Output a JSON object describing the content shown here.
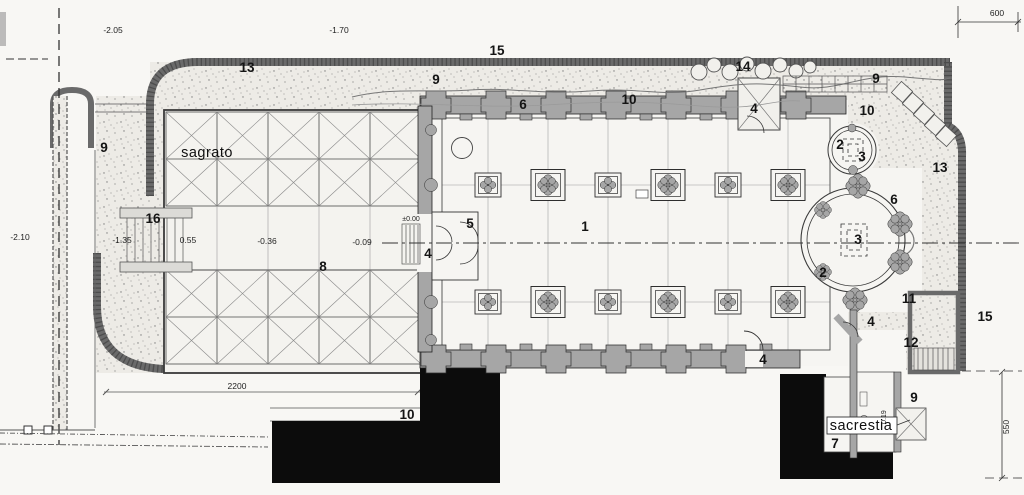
{
  "drawing": {
    "kind": "scanned architectural site plan of a church",
    "rooms": {
      "sagrato": "sagrato",
      "sacrestia": "sacrestia"
    }
  },
  "colors": {
    "paper": "#f8f7f4",
    "grass_base": "#edebe6",
    "wall_fill": "#a6a6a6",
    "wall_band": "#6a6a6a",
    "ink": "#2e2e2e",
    "black_mass": "#0c0c0c"
  },
  "labels": {
    "dim_205": "-2.05",
    "dim_170": "-1.70",
    "dim_600": "600",
    "dim_210": "-2.10",
    "dim_2200": "2200",
    "dim_550": "550",
    "lv_135": "-1.35",
    "lv_055": "0.55",
    "lv_036": "-0.36",
    "lv_009": "-0.09",
    "lv_000": "±0.00",
    "lv_019": "0.19",
    "n1": "1",
    "n2_chapel": "2",
    "n2_apse": "2",
    "n3_chapel": "3",
    "n3_altar": "3",
    "n4_north": "4",
    "n4_west": "4",
    "n4_south": "4",
    "n4_sacrestia": "4",
    "n5": "5",
    "n6_top": "6",
    "n6_apse": "6",
    "n7": "7",
    "n8": "8",
    "n9_left": "9",
    "n9_topcenter": "9",
    "n9_topright": "9",
    "n9_corridor": "9",
    "n10_topwall": "10",
    "n10_northeast": "10",
    "n10_bottom": "10",
    "n11": "11",
    "n12": "12",
    "n13_topleft": "13",
    "n13_right": "13",
    "n14": "14",
    "n15_top": "15",
    "n15_right": "15",
    "n16": "16",
    "sagrato": "sagrato",
    "sacrestia": "sacrestia"
  }
}
